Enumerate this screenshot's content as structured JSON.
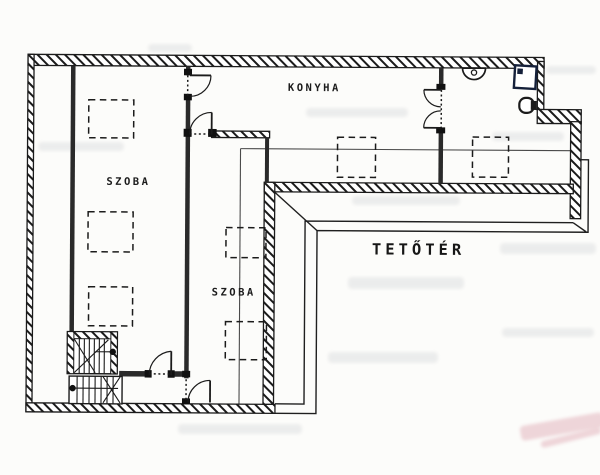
{
  "plan": {
    "labels": {
      "room_left": "SZOBA",
      "kitchen": "KONYHA",
      "room_middle": "SZOBA",
      "attic": "TETŐTÉR"
    },
    "colors": {
      "ink": "#1b1b1b",
      "paper": "#fcfcfa",
      "watermark_gray": "#9aa0a8",
      "watermark_pink": "#cf7d8e"
    }
  }
}
